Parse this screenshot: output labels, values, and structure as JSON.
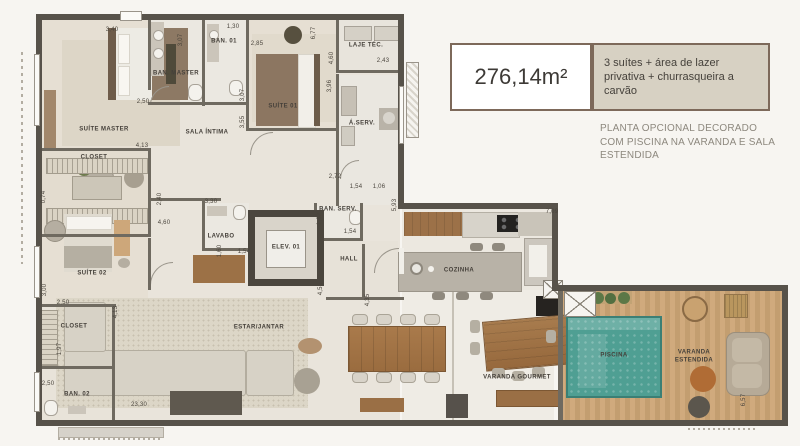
{
  "info_panel": {
    "area": "276,14m²",
    "features": "3 suítes + área de lazer privativa + churrasqueira a carvão",
    "note": "PLANTA OPCIONAL DECORADO COM PISCINA NA VARANDA E SALA ESTENDIDA",
    "colors": {
      "panel_border": "#7d695a",
      "panel_fill": "#d7d1c3",
      "wall": "#57524a",
      "pool_water": "#4f9f93",
      "deck_wood": "#cda87c",
      "wood_furniture": "#a0714a"
    }
  },
  "floor_plan": {
    "room_labels": [
      {
        "id": "suite-master",
        "label": "SUÍTE MASTER",
        "x": 104,
        "y": 130
      },
      {
        "id": "ban-master",
        "label": "BAN. MASTER",
        "x": 176,
        "y": 74
      },
      {
        "id": "ban-01",
        "label": "BAN. 01",
        "x": 224,
        "y": 42
      },
      {
        "id": "suite-01",
        "label": "SUÍTE 01",
        "x": 283,
        "y": 107
      },
      {
        "id": "laje-tec",
        "label": "LAJE TÉC.",
        "x": 366,
        "y": 46
      },
      {
        "id": "sala-intima",
        "label": "SALA ÍNTIMA",
        "x": 207,
        "y": 133
      },
      {
        "id": "a-serv",
        "label": "Á.SERV.",
        "x": 362,
        "y": 124
      },
      {
        "id": "ban-serv",
        "label": "BAN. SERV.",
        "x": 338,
        "y": 210
      },
      {
        "id": "lavabo",
        "label": "LAVABO",
        "x": 221,
        "y": 237
      },
      {
        "id": "elev-01",
        "label": "ELEV. 01",
        "x": 286,
        "y": 248
      },
      {
        "id": "hall",
        "label": "HALL",
        "x": 349,
        "y": 260
      },
      {
        "id": "closet-master",
        "label": "CLOSET",
        "x": 94,
        "y": 158
      },
      {
        "id": "suite-02",
        "label": "SUÍTE 02",
        "x": 92,
        "y": 274
      },
      {
        "id": "closet-02",
        "label": "CLOSET",
        "x": 74,
        "y": 327
      },
      {
        "id": "ban-02",
        "label": "BAN. 02",
        "x": 77,
        "y": 395
      },
      {
        "id": "estar-jantar",
        "label": "ESTAR/JANTAR",
        "x": 259,
        "y": 328
      },
      {
        "id": "cozinha",
        "label": "COZINHA",
        "x": 459,
        "y": 271
      },
      {
        "id": "varanda-gourmet",
        "label": "VARANDA GOURMET",
        "x": 517,
        "y": 378
      },
      {
        "id": "piscina",
        "label": "PISCINA",
        "x": 614,
        "y": 356
      },
      {
        "id": "varanda-estendida",
        "label": "VARANDA ESTENDIDA",
        "x": 694,
        "y": 357,
        "w": 64
      }
    ],
    "dimensions": [
      {
        "t": "3,40",
        "x": 112,
        "y": 30
      },
      {
        "t": "3,07",
        "x": 181,
        "y": 40,
        "v": true
      },
      {
        "t": "1,30",
        "x": 233,
        "y": 27
      },
      {
        "t": "2,85",
        "x": 257,
        "y": 44
      },
      {
        "t": "6,77",
        "x": 314,
        "y": 33,
        "v": true
      },
      {
        "t": "4,60",
        "x": 332,
        "y": 58,
        "v": true
      },
      {
        "t": "2,43",
        "x": 383,
        "y": 61
      },
      {
        "t": "3,96",
        "x": 330,
        "y": 86,
        "v": true
      },
      {
        "t": "2,50",
        "x": 143,
        "y": 102
      },
      {
        "t": "4,13",
        "x": 142,
        "y": 146
      },
      {
        "t": "3,07",
        "x": 243,
        "y": 95,
        "v": true
      },
      {
        "t": "3,55",
        "x": 243,
        "y": 122,
        "v": true
      },
      {
        "t": "2,72",
        "x": 335,
        "y": 177
      },
      {
        "t": "1,54",
        "x": 356,
        "y": 187
      },
      {
        "t": "1,06",
        "x": 379,
        "y": 187
      },
      {
        "t": "5,93",
        "x": 395,
        "y": 205,
        "v": true
      },
      {
        "t": "1,62",
        "x": 320,
        "y": 219,
        "v": true
      },
      {
        "t": "1,54",
        "x": 350,
        "y": 232
      },
      {
        "t": "3,30",
        "x": 211,
        "y": 202
      },
      {
        "t": "1,60",
        "x": 220,
        "y": 251,
        "v": true
      },
      {
        "t": "1,54",
        "x": 244,
        "y": 252
      },
      {
        "t": "2,40",
        "x": 160,
        "y": 199,
        "v": true
      },
      {
        "t": "4,60",
        "x": 164,
        "y": 223
      },
      {
        "t": "4,55",
        "x": 321,
        "y": 289,
        "v": true
      },
      {
        "t": "4,35",
        "x": 368,
        "y": 300,
        "v": true
      },
      {
        "t": "7,09",
        "x": 552,
        "y": 212
      },
      {
        "t": "0,74",
        "x": 44,
        "y": 197,
        "v": true
      },
      {
        "t": "3,00",
        "x": 45,
        "y": 290,
        "v": true
      },
      {
        "t": "2,50",
        "x": 63,
        "y": 303
      },
      {
        "t": "1,97",
        "x": 60,
        "y": 349,
        "v": true
      },
      {
        "t": "4,13",
        "x": 116,
        "y": 312,
        "v": true
      },
      {
        "t": "2,50",
        "x": 48,
        "y": 384
      },
      {
        "t": "23,30",
        "x": 139,
        "y": 405
      },
      {
        "t": "6,57",
        "x": 744,
        "y": 400,
        "v": true
      }
    ]
  }
}
